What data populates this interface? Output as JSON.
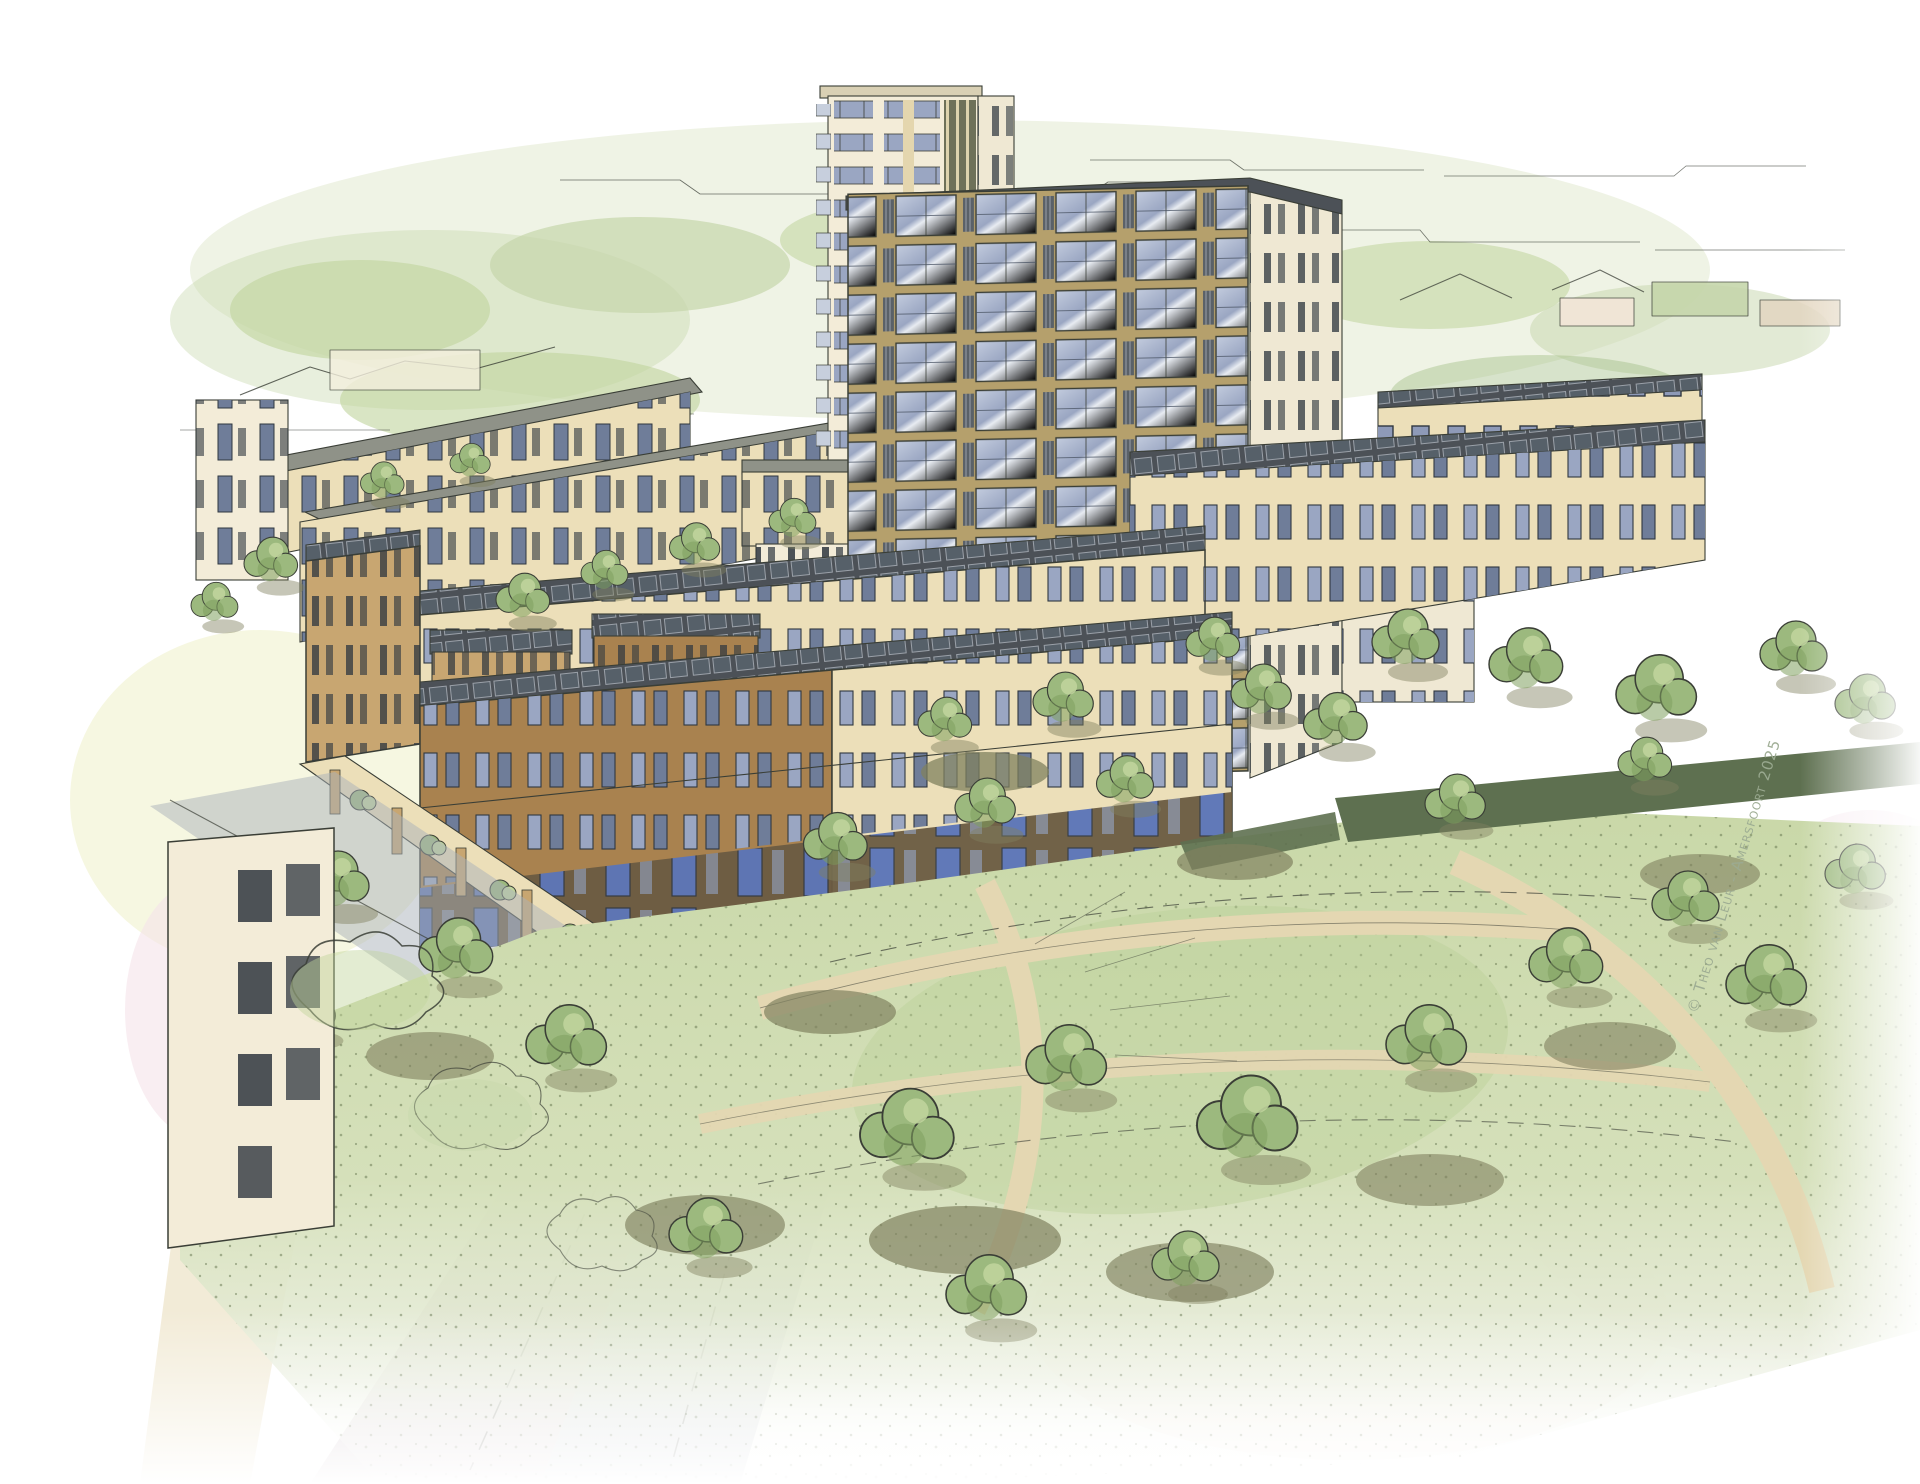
{
  "watermark": {
    "text": "© Theo van Leur - Amersfoort 2025",
    "color": "#9cab92"
  },
  "palette": {
    "paper": "#ffffff",
    "line": "#3a3e36",
    "washgreen": "#dfe7cb",
    "washgreendeep": "#c6d6ab",
    "washyellow": "#eef0c9",
    "washpink": "#f5e3ea",
    "washpeach": "#f3e6d8",
    "treemid": "#9cb97e",
    "treelight": "#c0d49c",
    "treedeep": "#7fa05f",
    "shadowolive": "#80815f",
    "shadowmauve": "#a9a2ae",
    "lawn": "#cfdcae",
    "lawndeep": "#b9cf96",
    "pathbeige": "#e8dcb7",
    "pavement": "#ece2c6",
    "roadgrey": "#aab2b9",
    "roadmauve": "#d8cdd3",
    "hedgedark": "#5e7050",
    "wallcream": "#ecdfb9",
    "wallcreamlight": "#f3ecd8",
    "walltan": "#c8a671",
    "wallbrown": "#a9824f",
    "towertan": "#b5a06c",
    "towercream": "#efe8d3",
    "glassblue": "#9aa6c2",
    "glassdeep": "#6f7d99",
    "framedark": "#2f3740",
    "roofgrey": "#8f9288",
    "roofdark": "#4c5157",
    "solardark": "#566069",
    "balconyslat": "#5a6168",
    "bandblue": "#c7cfdd",
    "stripedark": "#6e7159",
    "doorblue": "#5a74b8",
    "watermark": "#9cab92"
  }
}
